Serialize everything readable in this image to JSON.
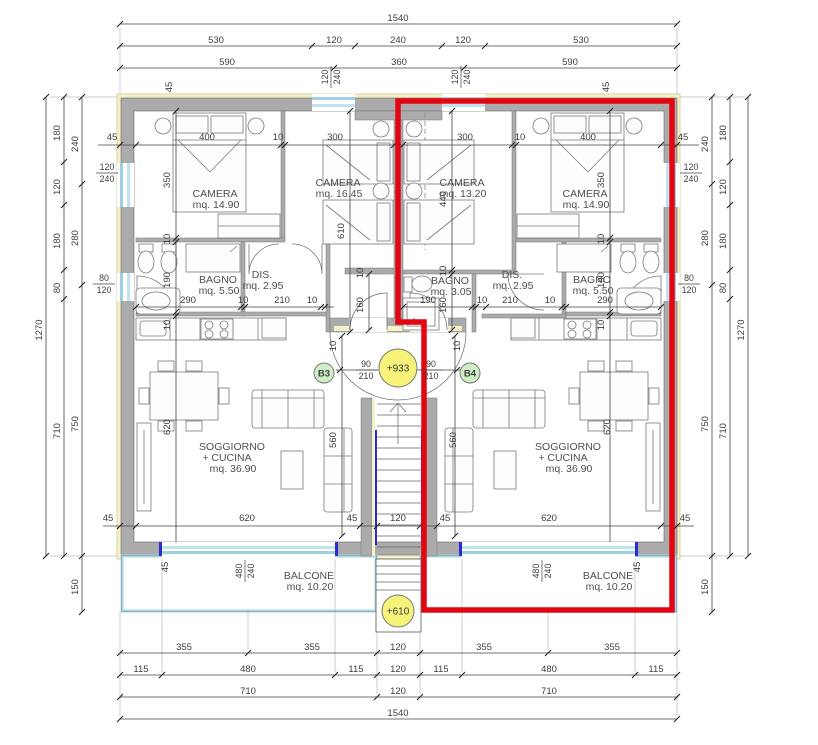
{
  "title": "Floor plan - two apartments with staircase",
  "colors": {
    "wall_gray": "#ababab",
    "insulation_yellow": "#f6f2c8",
    "window_blue": "#9fd0e2",
    "balcony_blue": "#a5d8e9",
    "selection_red": "#e20613",
    "unit_marker_bg": "#cfeec5",
    "unit_marker_text": "#2e7d1f",
    "level_marker_bg": "#f7f279",
    "structure_blue": "#2b2bd5"
  },
  "plan": {
    "rooms": [
      {
        "name": "CAMERA",
        "area": "mq. 14.90",
        "x": 215,
        "y": 197
      },
      {
        "name": "CAMERA",
        "area": "mq. 16.45",
        "x": 338,
        "y": 186
      },
      {
        "name": "CAMERA",
        "area": "mq. 13.20",
        "x": 462,
        "y": 186
      },
      {
        "name": "CAMERA",
        "area": "mq. 14.90",
        "x": 585,
        "y": 197
      },
      {
        "name": "BAGNO",
        "area": "mq. 5.50",
        "x": 218,
        "y": 283
      },
      {
        "name": "DIS.",
        "area": "mq. 2.95",
        "x": 262,
        "y": 278
      },
      {
        "name": "BAGNO",
        "area": "mq. 3.05",
        "x": 450,
        "y": 284
      },
      {
        "name": "DIS.",
        "area": "mq. 2.95",
        "x": 512,
        "y": 278
      },
      {
        "name": "BAGNO",
        "area": "mq. 5.50",
        "x": 592,
        "y": 283
      },
      {
        "name": "SOGGIORNO",
        "name2": "+ CUCINA",
        "area": "mq. 36.90",
        "x": 232,
        "y": 450
      },
      {
        "name": "SOGGIORNO",
        "name2": "+ CUCINA",
        "area": "mq. 36.90",
        "x": 568,
        "y": 450
      },
      {
        "name": "BALCONE",
        "area": "mq. 10.20",
        "x": 309,
        "y": 579
      },
      {
        "name": "BALCONE",
        "area": "mq. 10.20",
        "x": 608,
        "y": 579
      }
    ],
    "markers": [
      {
        "label": "B3",
        "x": 324,
        "y": 373,
        "r": 10,
        "kind": "unit"
      },
      {
        "label": "B4",
        "x": 470,
        "y": 373,
        "r": 10,
        "kind": "unit"
      },
      {
        "label": "+933",
        "x": 398,
        "y": 368,
        "r": 19,
        "kind": "level"
      },
      {
        "label": "+610",
        "x": 398,
        "y": 611,
        "r": 16,
        "kind": "level"
      }
    ],
    "window_tags": [
      [
        "120",
        "240",
        107,
        172,
        0
      ],
      [
        "80",
        "120",
        104,
        283,
        0
      ],
      [
        "120",
        "240",
        691,
        172,
        0
      ],
      [
        "80",
        "120",
        689,
        283,
        0
      ],
      [
        "120",
        "240",
        330,
        77,
        1
      ],
      [
        "120",
        "240",
        460,
        77,
        1
      ],
      [
        "480",
        "240",
        244,
        571,
        1
      ],
      [
        "480",
        "240",
        541,
        571,
        1
      ]
    ],
    "door_tags": [
      [
        "90",
        "210",
        366,
        369,
        0
      ],
      [
        "90",
        "210",
        431,
        369,
        0
      ]
    ],
    "dims": [
      [
        "1540",
        398,
        18,
        0
      ],
      [
        "530",
        216,
        40,
        0
      ],
      [
        "120",
        334,
        40,
        0
      ],
      [
        "240",
        398,
        40,
        0
      ],
      [
        "120",
        463,
        40,
        0
      ],
      [
        "530",
        581,
        40,
        0
      ],
      [
        "590",
        227,
        62,
        0
      ],
      [
        "360",
        399,
        62,
        0
      ],
      [
        "590",
        570,
        62,
        0
      ],
      [
        "45",
        172,
        84,
        1
      ],
      [
        "45",
        609,
        84,
        1
      ],
      [
        "355",
        184,
        647,
        0
      ],
      [
        "355",
        312,
        647,
        0
      ],
      [
        "120",
        398,
        647,
        0
      ],
      [
        "355",
        484,
        647,
        0
      ],
      [
        "355",
        612,
        647,
        0
      ],
      [
        "115",
        141,
        669,
        0
      ],
      [
        "480",
        248,
        669,
        0
      ],
      [
        "115",
        356,
        669,
        0
      ],
      [
        "120",
        398,
        669,
        0
      ],
      [
        "115",
        441,
        669,
        0
      ],
      [
        "480",
        549,
        669,
        0
      ],
      [
        "115",
        656,
        669,
        0
      ],
      [
        "710",
        248,
        691,
        0
      ],
      [
        "120",
        398,
        691,
        0
      ],
      [
        "710",
        549,
        691,
        0
      ],
      [
        "1540",
        398,
        713,
        0
      ],
      [
        "1270",
        42,
        327,
        1
      ],
      [
        "180",
        60,
        130,
        1
      ],
      [
        "120",
        60,
        184,
        1
      ],
      [
        "180",
        60,
        238,
        1
      ],
      [
        "80",
        60,
        285,
        1
      ],
      [
        "710",
        60,
        428,
        1
      ],
      [
        "240",
        78,
        141,
        1
      ],
      [
        "280",
        78,
        235,
        1
      ],
      [
        "750",
        78,
        421,
        1
      ],
      [
        "150",
        78,
        584,
        1
      ],
      [
        "240",
        708,
        141,
        1
      ],
      [
        "280",
        708,
        235,
        1
      ],
      [
        "750",
        708,
        421,
        1
      ],
      [
        "150",
        708,
        584,
        1
      ],
      [
        "180",
        726,
        130,
        1
      ],
      [
        "120",
        726,
        184,
        1
      ],
      [
        "180",
        726,
        238,
        1
      ],
      [
        "80",
        726,
        285,
        1
      ],
      [
        "710",
        726,
        428,
        1
      ],
      [
        "1270",
        744,
        327,
        1
      ],
      [
        "45",
        112,
        137,
        0
      ],
      [
        "400",
        207,
        137,
        0
      ],
      [
        "10",
        278,
        137,
        0
      ],
      [
        "300",
        335,
        137,
        0
      ],
      [
        "300",
        465,
        137,
        0
      ],
      [
        "10",
        520,
        137,
        0
      ],
      [
        "400",
        588,
        137,
        0
      ],
      [
        "45",
        683,
        137,
        0
      ],
      [
        "350",
        170,
        177,
        1
      ],
      [
        "10",
        170,
        236,
        1
      ],
      [
        "190",
        170,
        277,
        1
      ],
      [
        "10",
        170,
        322,
        1
      ],
      [
        "350",
        604,
        177,
        1
      ],
      [
        "10",
        604,
        236,
        1
      ],
      [
        "190",
        604,
        277,
        1
      ],
      [
        "10",
        604,
        322,
        1
      ],
      [
        "610",
        344,
        228,
        1
      ],
      [
        "440",
        446,
        196,
        1
      ],
      [
        "10",
        446,
        268,
        1
      ],
      [
        "160",
        446,
        302,
        1
      ],
      [
        "10",
        363,
        270,
        1
      ],
      [
        "160",
        363,
        302,
        1
      ],
      [
        "290",
        188,
        300,
        0
      ],
      [
        "10",
        243,
        300,
        0
      ],
      [
        "210",
        282,
        300,
        0
      ],
      [
        "10",
        312,
        300,
        0
      ],
      [
        "190",
        428,
        300,
        0
      ],
      [
        "10",
        482,
        300,
        0
      ],
      [
        "210",
        510,
        300,
        0
      ],
      [
        "10",
        550,
        300,
        0
      ],
      [
        "290",
        605,
        300,
        0
      ],
      [
        "10",
        336,
        343,
        1
      ],
      [
        "10",
        460,
        343,
        1
      ],
      [
        "45",
        108,
        518,
        0
      ],
      [
        "620",
        247,
        518,
        0
      ],
      [
        "45",
        352,
        518,
        0
      ],
      [
        "120",
        398,
        518,
        0
      ],
      [
        "45",
        445,
        518,
        0
      ],
      [
        "620",
        549,
        518,
        0
      ],
      [
        "45",
        685,
        518,
        0
      ],
      [
        "560",
        336,
        437,
        1
      ],
      [
        "560",
        456,
        437,
        1
      ],
      [
        "620",
        170,
        424,
        1
      ],
      [
        "620",
        610,
        424,
        1
      ],
      [
        "45",
        168,
        564,
        1
      ],
      [
        "45",
        640,
        564,
        1
      ]
    ]
  }
}
